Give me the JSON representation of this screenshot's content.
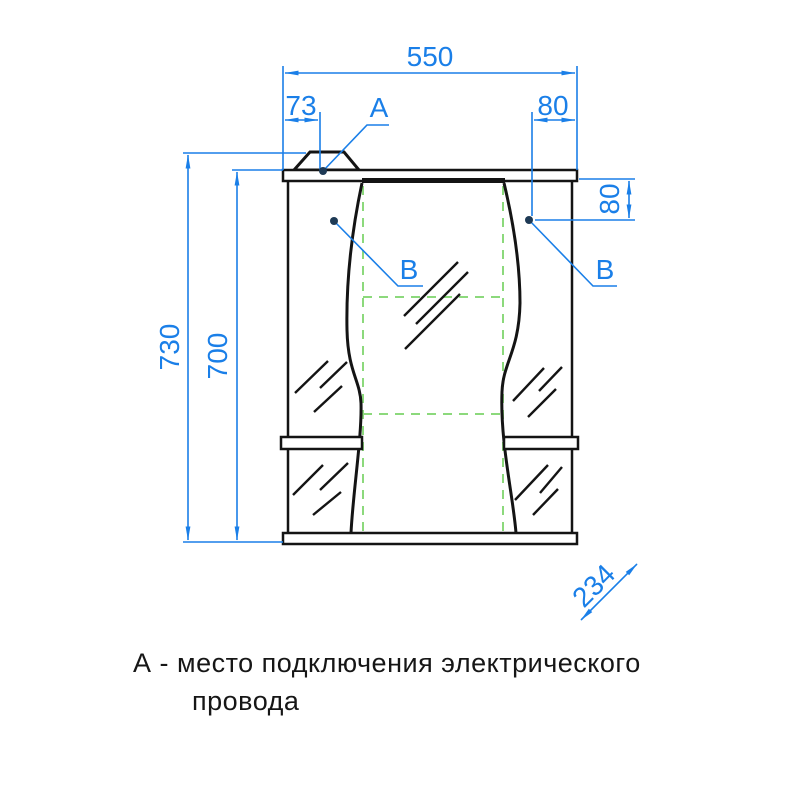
{
  "drawing": {
    "title": "mirror-cabinet-front-view",
    "dimensions": {
      "width_top": "550",
      "lamp_offset": "73",
      "right_offset": "80",
      "right_drop": "80",
      "height_outer": "730",
      "height_inner": "700",
      "depth": "234"
    },
    "callouts": {
      "a": "A",
      "b_left": "B",
      "b_right": "B"
    },
    "note": {
      "line1": "А - место подключения электрического",
      "line2": "провода"
    },
    "colors": {
      "dimension_blue": "#1a7fe8",
      "hidden_green": "#8cd97c",
      "outline_black": "#141414",
      "leader_dot": "#1e3a55"
    }
  }
}
